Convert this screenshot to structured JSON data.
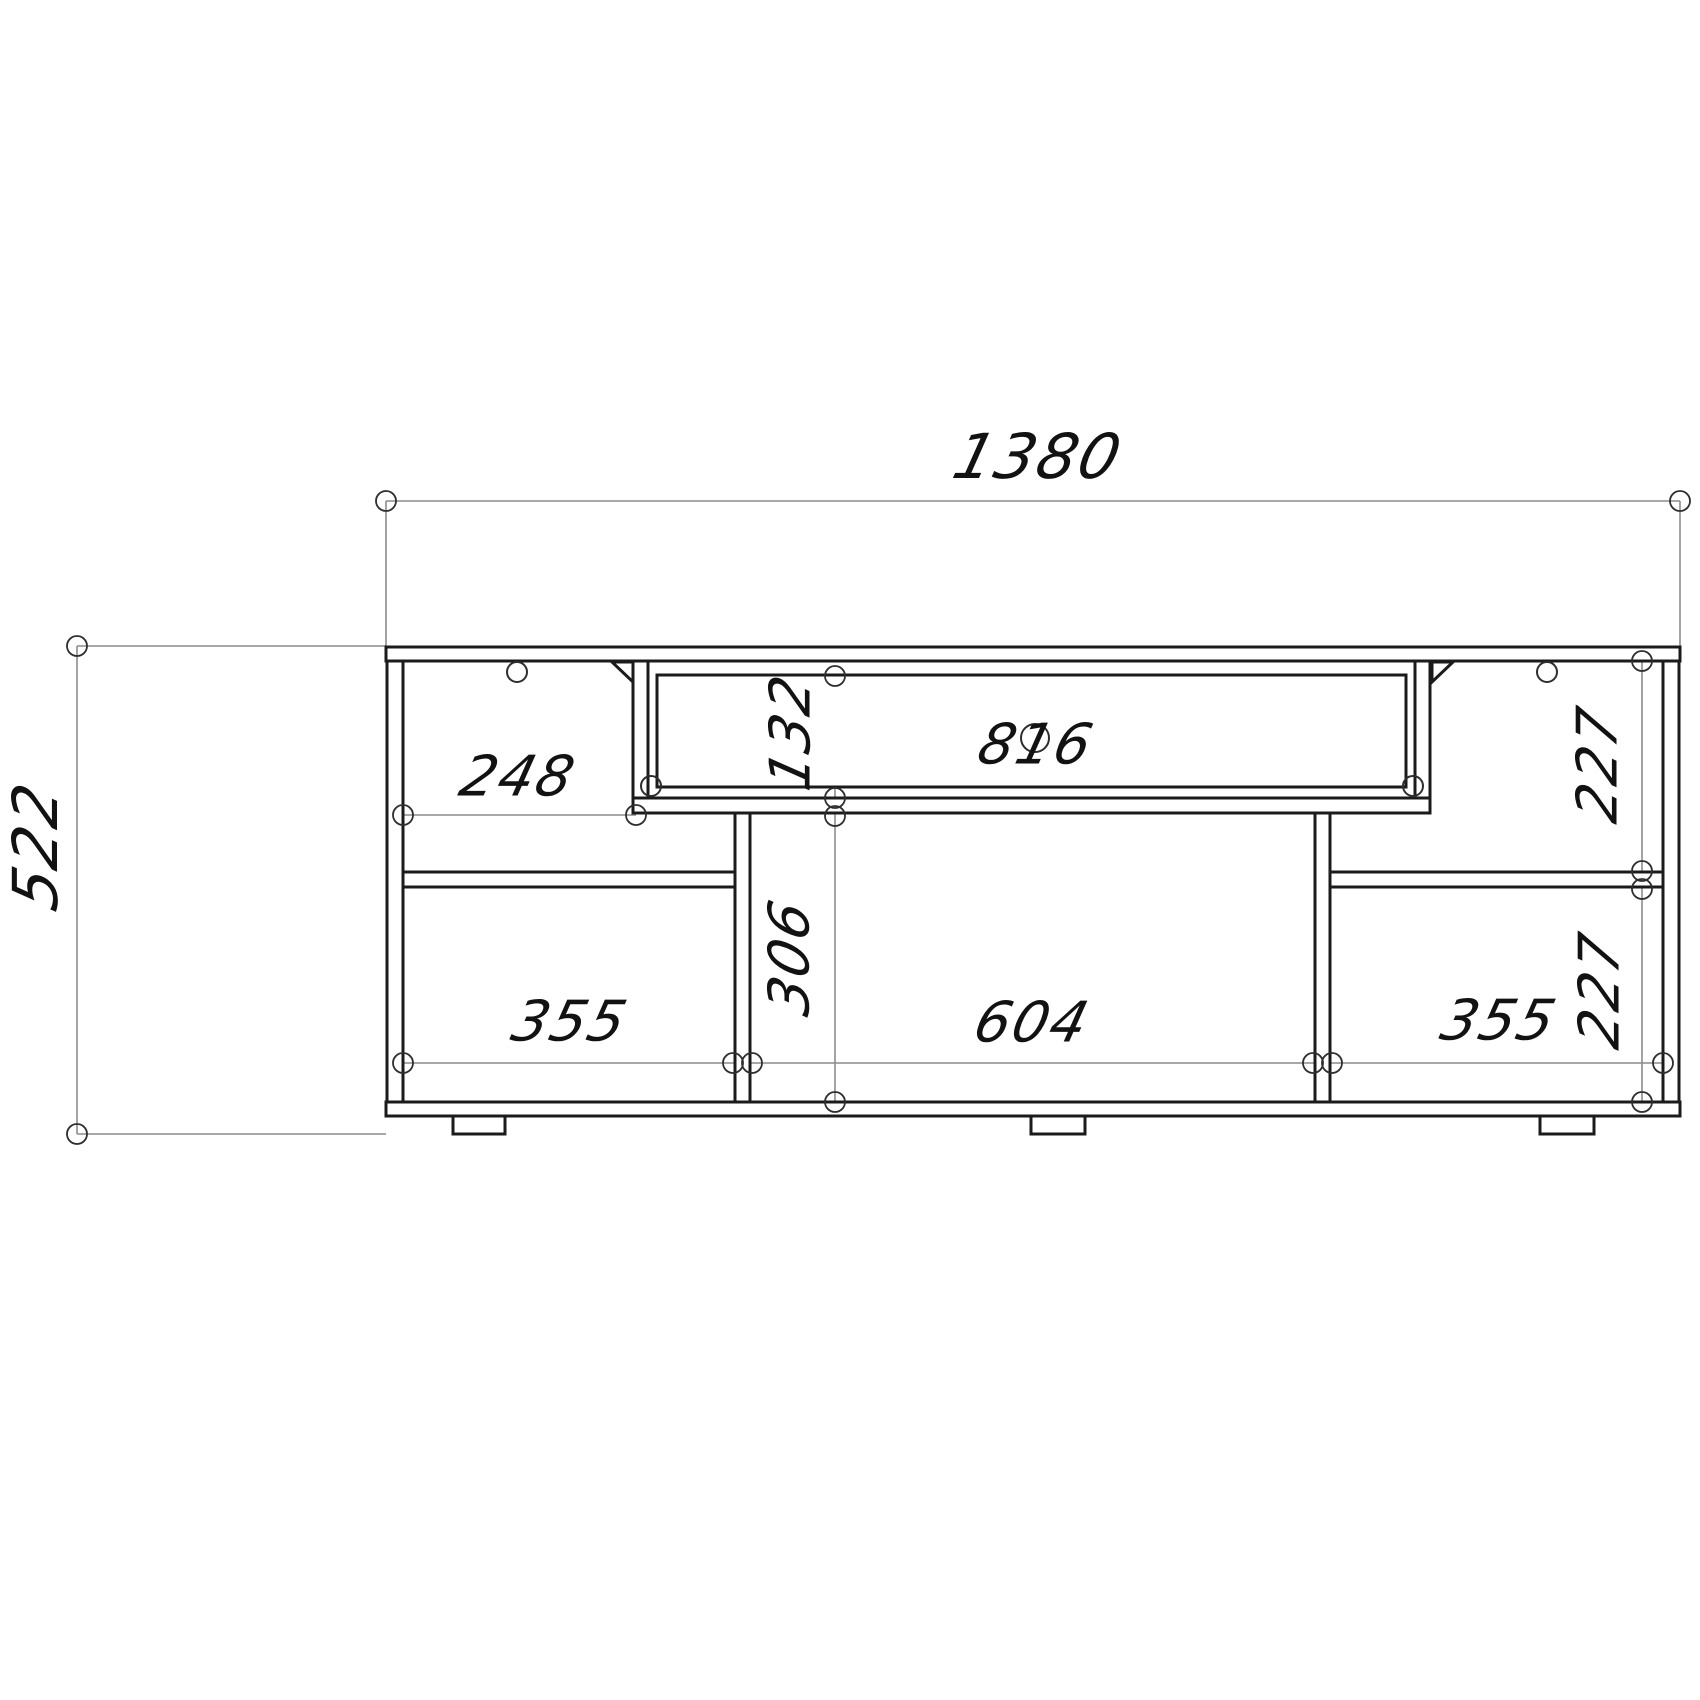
{
  "drawing": {
    "type": "furniture-elevation",
    "labels": {
      "overall_width": "1380",
      "overall_height": "522",
      "left_bay_width": "248",
      "drawer_front_height": "132",
      "drawer_width": "816",
      "right_upper_bay_height": "227",
      "left_lower_bay_width": "355",
      "center_bay_height": "306",
      "center_bay_width": "604",
      "right_lower_bay_width": "355",
      "right_lower_bay_height": "227"
    },
    "colors": {
      "background": "#ffffff",
      "structural_line": "#1b1b1b",
      "dimension_line": "#8c8c8c",
      "text": "#121212"
    }
  }
}
